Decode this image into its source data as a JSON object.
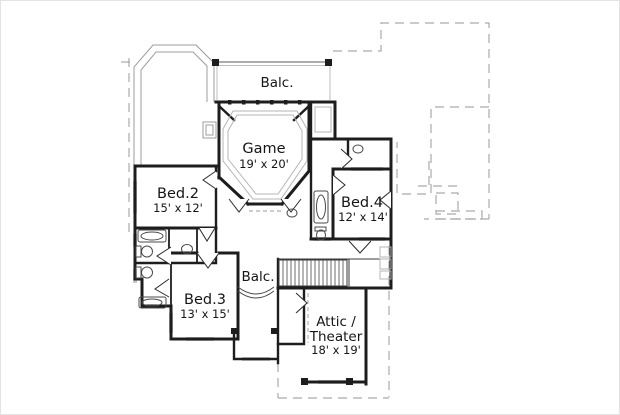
{
  "rooms": {
    "balcony_top": {
      "name": "Balc."
    },
    "game": {
      "name": "Game",
      "dims": "19' x 20'"
    },
    "bed2": {
      "name": "Bed.2",
      "dims": "15' x 12'"
    },
    "bed4": {
      "name": "Bed.4",
      "dims": "12' x 14'"
    },
    "balcony_mid": {
      "name": "Balc."
    },
    "bed3": {
      "name": "Bed.3",
      "dims": "13' x 15'"
    },
    "attic": {
      "name_line1": "Attic /",
      "name_line2": "Theater",
      "dims": "18' x 19'"
    }
  },
  "colors": {
    "background": "#ffffff",
    "wall": "#1d1d1d",
    "roofline_dashed": "#aaaaaa",
    "turret_outline": "#9c9c9c",
    "window": "#c7c7c7",
    "text": "#151515"
  },
  "fixture_icons": [
    "bathtub-icon",
    "toilet-icon",
    "sink-icon",
    "staircase",
    "balcony-rail",
    "door-swing"
  ]
}
